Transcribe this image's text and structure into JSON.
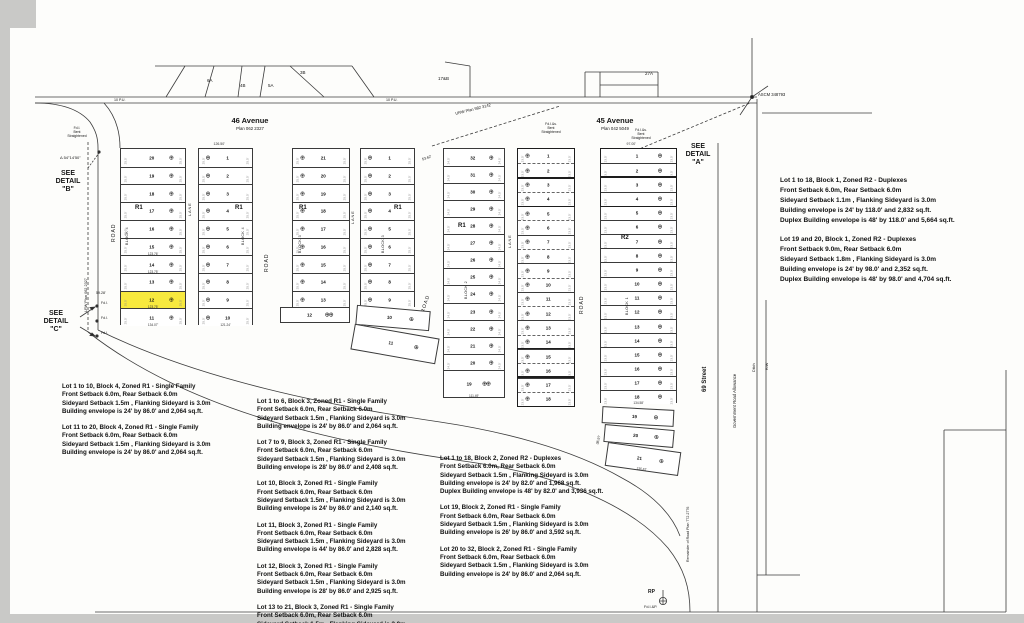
{
  "labels": {
    "avenue46": {
      "name": "46 Avenue",
      "plan": "Plan 062 2327"
    },
    "avenue45": {
      "name": "45 Avenue",
      "plan": "Plan 042 5049"
    },
    "street69": "69 Street",
    "gov_road": "Government Road Allowance",
    "ditch": "Ditch",
    "rw": "R/W",
    "remainder_road": "Remainder of Road Plan 772 2776",
    "lrw_plan": "LRW Plan 062 2327",
    "urw_plan": "URW Plan 982 3142",
    "ascm": "ASCM 348793",
    "rp": "RP",
    "fdip": "Fd.I.&P.",
    "road": "ROAD",
    "lane": "LANE",
    "see_detail_a": [
      "SEE",
      "DETAIL",
      "\"A\""
    ],
    "see_detail_b": [
      "SEE",
      "DETAIL",
      "\"B\""
    ],
    "see_detail_c": [
      "SEE",
      "DETAIL",
      "\"C\""
    ],
    "found_left": [
      "Fd.I.",
      "Bent",
      "Straightened"
    ],
    "found_mid": [
      "Fd.I.&s.",
      "Bent",
      "Straightened"
    ],
    "found_right": [
      "Fd.I.&s.",
      "Bent",
      "Straightened"
    ],
    "angle_b": "Δ 54°14'50\"",
    "fdi1": "Fd.I.",
    "fdi2": "Fd.I.",
    "fdi3": "Fd.I.",
    "parcel_6a": "6A",
    "parcel_4b": "4B",
    "parcel_5a": "5A",
    "parcel_3b": "3B",
    "parcel_17b": "17&B",
    "parcel_27a": "27A",
    "pu1": "10 P.U.",
    "pu2": "10 P.U.",
    "dim_5928": "59.28'",
    "dim_5362": "53.62'",
    "dim_9700": "97.00'",
    "dim_12650": "126.50'",
    "dim_3697": "36.97",
    "dim_2125": "21.25"
  },
  "highlight_color": "#f7e93e",
  "strips": [
    {
      "block": "BLOCK 4",
      "zone": "R1",
      "lots": [
        "20",
        "19",
        "18",
        "17",
        "16",
        "15",
        "14",
        "13",
        "12",
        "11"
      ],
      "highlight": "12",
      "lot_dims": {
        "15": "123.76'",
        "14": "123.75'",
        "12": "123.75'",
        "11": "134.07'"
      },
      "edge_dim": "25.5'"
    },
    {
      "block": "BLOCK 4",
      "zone": "R1",
      "lots": [
        "1",
        "2",
        "3",
        "4",
        "5",
        "6",
        "7",
        "8",
        "9",
        "10"
      ],
      "lot_dims": {
        "10": "121.24'"
      },
      "edge_dim": "25.5'",
      "top_dim": "126.50'"
    },
    {
      "block": "BLOCK 3",
      "zone": "R1",
      "lots": [
        "21",
        "20",
        "19",
        "18",
        "17",
        "16",
        "15",
        "14",
        "13"
      ],
      "tail": {
        "n": "12",
        "double": true
      },
      "edge_dim": "25.5'"
    },
    {
      "block": "BLOCK 3",
      "zone": "R1",
      "lots": [
        "1",
        "2",
        "3",
        "4",
        "5",
        "6",
        "7",
        "8",
        "9"
      ],
      "angled": [
        {
          "n": "10"
        },
        {
          "n": "11"
        }
      ],
      "edge_dim": "25.5'"
    },
    {
      "block": "BLOCK 2",
      "zone": "R1",
      "lots": [
        "32",
        "31",
        "30",
        "29",
        "28",
        "27",
        "26",
        "25",
        "24",
        "23",
        "22",
        "21",
        "20"
      ],
      "tail": {
        "n": "19",
        "double": true,
        "dim": "111.49'"
      },
      "edge_dim": "24.5'"
    },
    {
      "block": "BLOCK 2",
      "zone": "",
      "duplex": true,
      "lots": [
        "1",
        "2",
        "3",
        "4",
        "5",
        "6",
        "7",
        "8",
        "9",
        "10",
        "11",
        "12",
        "13",
        "14",
        "15",
        "16",
        "17",
        "18"
      ],
      "bold_pairs": [
        [
          0,
          1
        ],
        [
          2,
          3
        ],
        [
          14,
          15
        ],
        [
          16,
          17
        ]
      ],
      "edge_dim": "23.5'"
    },
    {
      "block": "BLOCK 1",
      "zone": "R2",
      "lots": [
        "1",
        "2",
        "3",
        "4",
        "5",
        "6",
        "7",
        "8",
        "9",
        "10",
        "11",
        "12",
        "13",
        "14",
        "15",
        "16",
        "17",
        "18"
      ],
      "bold_pairs": [
        [
          0,
          1
        ],
        [
          2,
          3
        ]
      ],
      "lot_dims": {
        "18": "134.58'"
      },
      "angled": [
        {
          "n": "19"
        },
        {
          "n": "20"
        },
        {
          "n": "21",
          "dim": "136.42'"
        }
      ],
      "edge_dim": "23.5'",
      "top_dim": "97.00'"
    }
  ],
  "notes_cols": [
    {
      "name": "block4-notes",
      "paragraphs": [
        [
          "Lot 1 to 10, Block 4, Zoned R1 - Single Family",
          "Front Setback 6.0m, Rear Setback 6.0m",
          "Sideyard Setback 1.5m , Flanking Sideyard is 3.0m",
          "Building envelope is 24' by 86.0'  and 2,064 sq.ft."
        ],
        [
          "Lot 11 to 20, Block 4, Zoned R1 - Single Family",
          "Front Setback 6.0m, Rear Setback 6.0m",
          "Sideyard Setback 1.5m , Flanking Sideyard is 3.0m",
          "Building envelope is 24' by 86.0'  and 2,064 sq.ft."
        ]
      ]
    },
    {
      "name": "block3-notes",
      "paragraphs": [
        [
          "Lot 1 to 6, Block 3, Zoned R1 - Single Family",
          "Front Setback 6.0m, Rear Setback 6.0m",
          "Sideyard Setback 1.5m , Flanking Sideyard is 3.0m",
          "Building envelope is 24' by 86.0'  and 2,064 sq.ft."
        ],
        [
          "Lot 7 to 9, Block 3, Zoned R1 - Single Family",
          "Front Setback 6.0m, Rear Setback 6.0m",
          "Sideyard Setback 1.5m , Flanking Sideyard is 3.0m",
          "Building envelope is 28' by 86.0'  and 2,408 sq.ft."
        ],
        [
          "Lot 10, Block 3, Zoned R1 - Single Family",
          "Front Setback 6.0m, Rear Setback 6.0m",
          "Sideyard Setback 1.5m , Flanking Sideyard is 3.0m",
          "Building envelope is 24' by 86.0'  and 2,140 sq.ft."
        ],
        [
          "Lot 11, Block 3, Zoned R1 - Single Family",
          "Front Setback 6.0m, Rear Setback 6.0m",
          "Sideyard Setback 1.5m , Flanking Sideyard is 3.0m",
          "Building envelope is 44' by 86.0'  and 2,828 sq.ft."
        ],
        [
          "Lot 12, Block 3, Zoned R1 - Single Family",
          "Front Setback 6.0m, Rear Setback 6.0m",
          "Sideyard Setback 1.5m , Flanking Sideyard is 3.0m",
          "Building envelope is 28' by 86.0'  and 2,925 sq.ft."
        ],
        [
          "Lot 13 to 21, Block 3, Zoned R1 - Single Family",
          "Front Setback 6.0m, Rear Setback 6.0m",
          "Sideyard Setback 1.5m , Flanking Sideyard is 3.0m"
        ]
      ]
    },
    {
      "name": "block2-notes",
      "paragraphs": [
        [
          "Lot 1 to 18, Block 2, Zoned R2 - Duplexes",
          "Front Setback 6.0m, Rear Setback 6.0m",
          "Sideyard Setback 1.5m , Flanking Sideyard is 3.0m",
          "Building envelope is 24' by 82.0'  and 1,968 sq.ft.",
          "Duplex Building envelope is 48' by 82.0'  and 3,936 sq.ft."
        ],
        [
          "Lot 19, Block 2, Zoned R1 - Single Family",
          "Front Setback 6.0m, Rear Setback 6.0m",
          "Sideyard Setback 1.5m , Flanking Sideyard is 3.0m",
          "Building envelope is 26' by 86.0'  and 3,592 sq.ft."
        ],
        [
          "Lot 20 to 32, Block 2, Zoned R1 - Single Family",
          "Front Setback 6.0m, Rear Setback 6.0m",
          "Sideyard Setback 1.5m , Flanking Sideyard is 3.0m",
          "Building envelope is 24' by 86.0'  and 2,064 sq.ft."
        ]
      ]
    },
    {
      "name": "block1-notes",
      "paragraphs": [
        [
          "Lot 1 to 18, Block 1, Zoned R2 - Duplexes",
          "Front Setback 6.0m, Rear Setback 6.0m",
          "Sideyard Setback 1.1m , Flanking Sideyard is 3.0m",
          "Building envelope is 24' by 118.0'  and 2,832 sq.ft.",
          "Duplex Building envelope is 48' by 118.0'  and 5,664 sq.ft."
        ],
        [
          "Lot 19 and 20, Block 1, Zoned R2 - Duplexes",
          "Front Setback 9.0m, Rear Setback 6.0m",
          "Sideyard Setback 1.8m , Flanking Sideyard is 3.0m",
          "Building envelope is 24' by 98.0'  and 2,352 sq.ft.",
          "Duplex Building envelope is 48' by 98.0'  and 4,704 sq.ft."
        ]
      ]
    }
  ]
}
